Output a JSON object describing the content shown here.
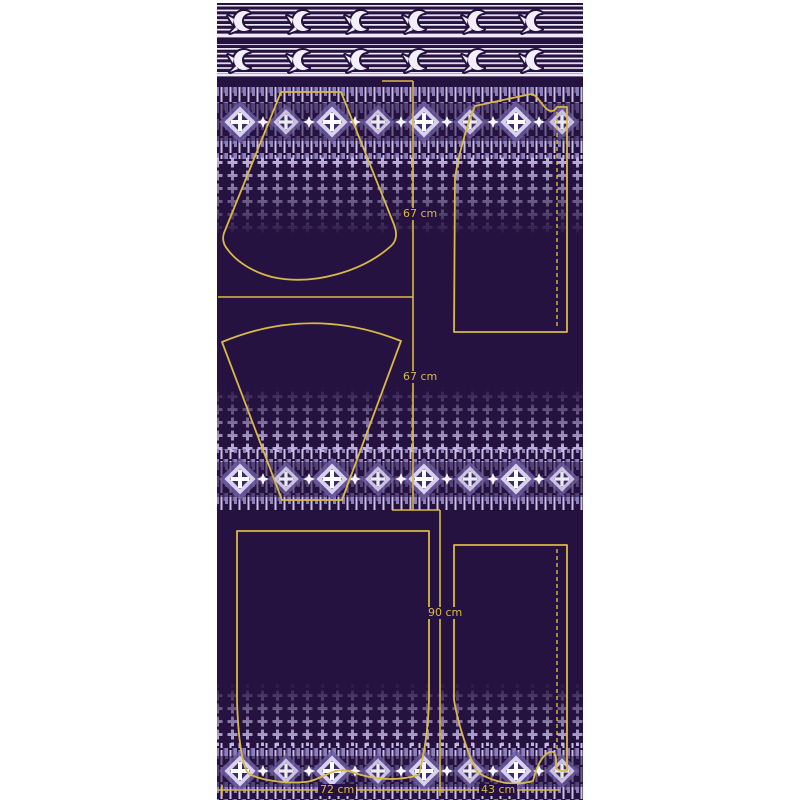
{
  "panel": {
    "description_motifs": {
      "bird_border": "swallow-bird-motif",
      "ornament_band": "diamond-medallion-motif",
      "texture": "plus-cross-texture",
      "fold_line": "dashed-fold-line"
    },
    "colors": {
      "panel_background": "#261240",
      "page_margin": "#ffffff",
      "pattern_line_yellow": "#d9b945",
      "ornament_white": "#f2eff9",
      "ornament_light": "#d9d2ee",
      "ornament_mid": "#9b8ec6",
      "ornament_dark_inner": "#3b2d6b"
    }
  },
  "measurements": {
    "gore_top_length": "67 cm",
    "gore_bottom_length": "67 cm",
    "panel_height": "90 cm",
    "panel_width_left": "72 cm",
    "panel_width_right": "43 cm"
  }
}
